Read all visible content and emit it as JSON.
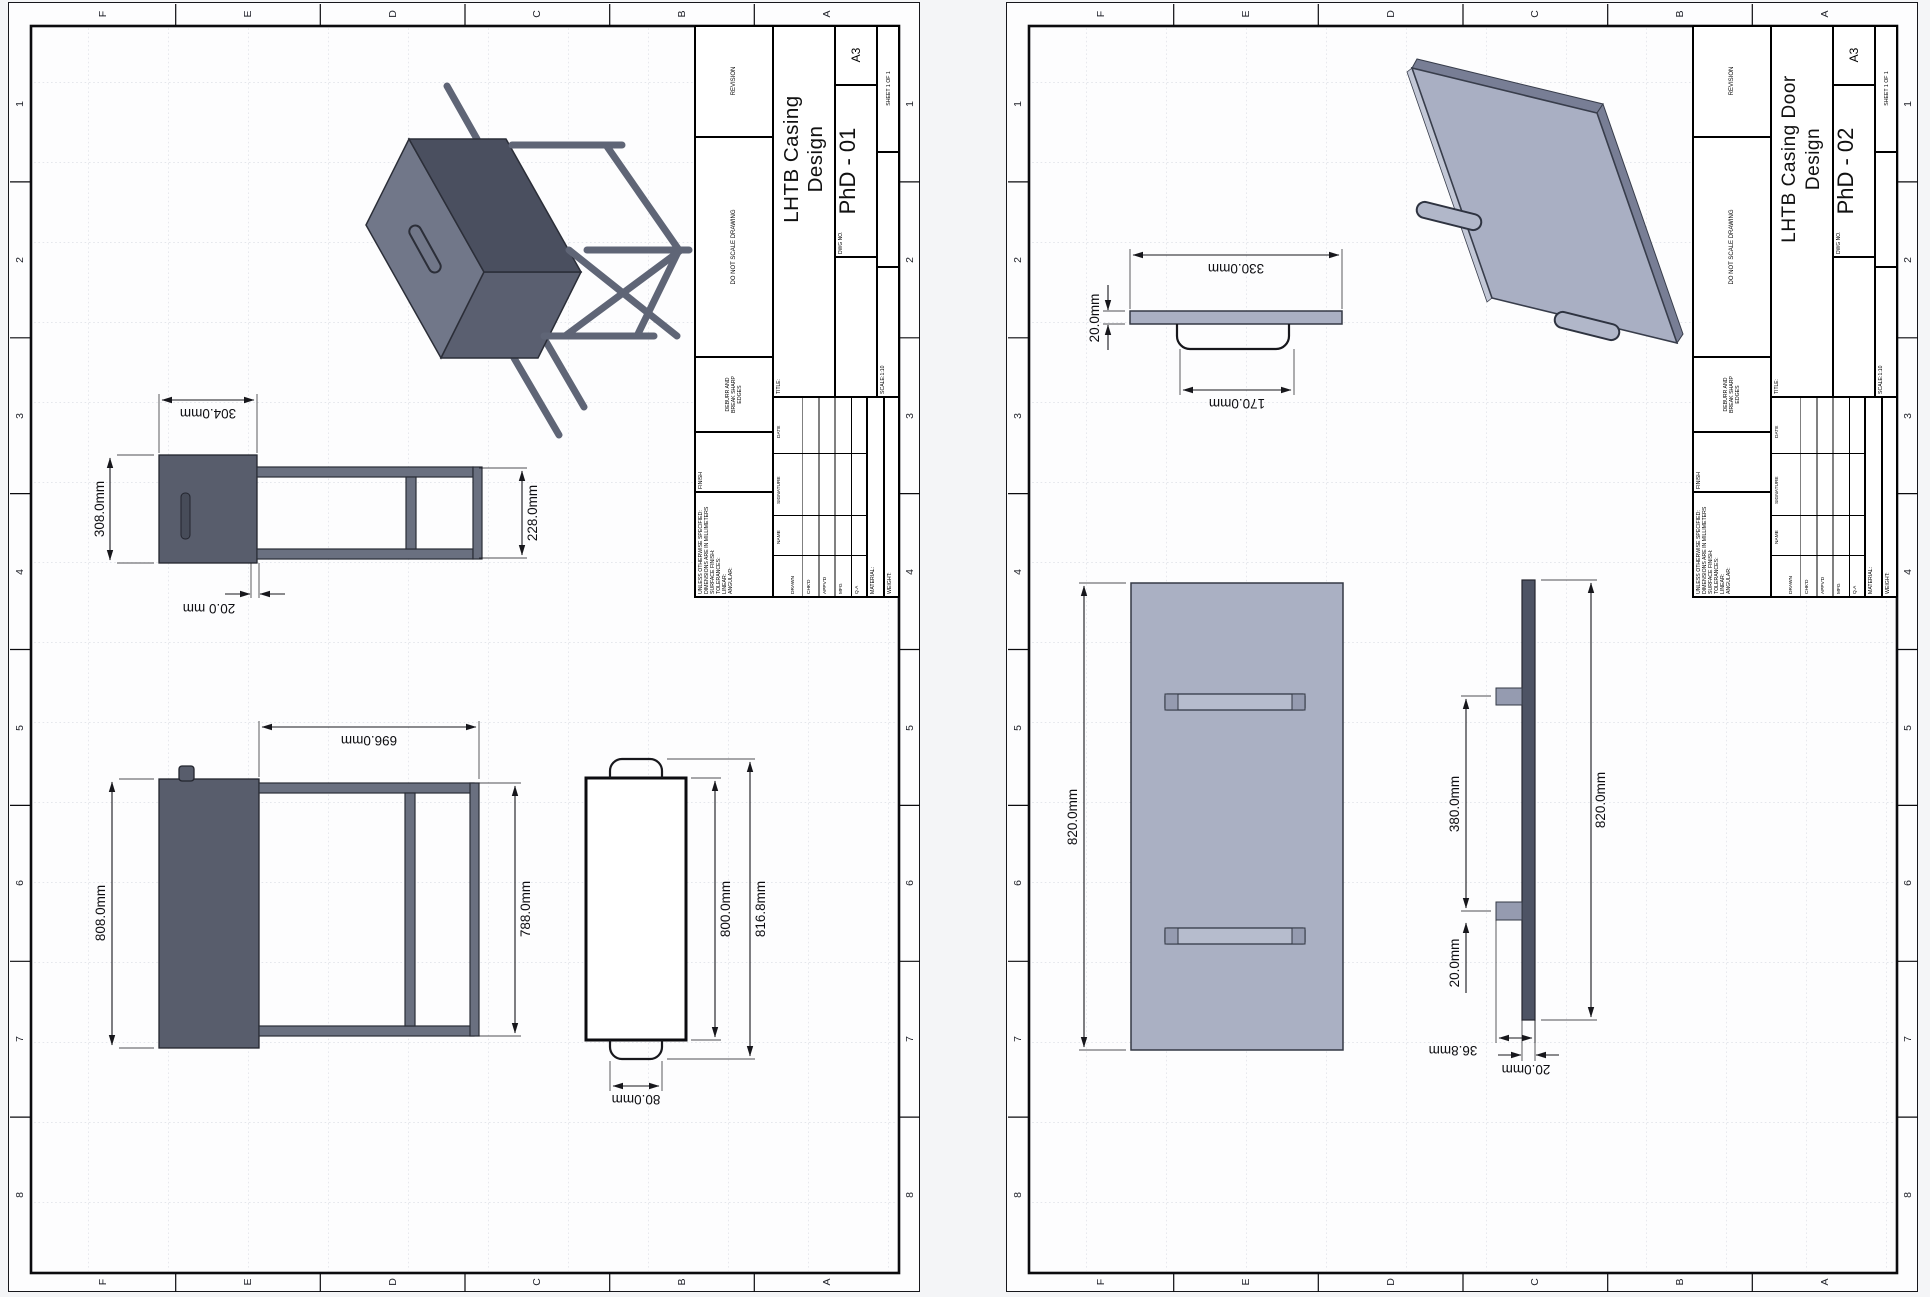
{
  "zones": {
    "letters": [
      "F",
      "E",
      "D",
      "C",
      "B",
      "A"
    ],
    "numbers": [
      "1",
      "2",
      "3",
      "4",
      "5",
      "6",
      "7",
      "8"
    ]
  },
  "titleblock": {
    "unless_lines": [
      "UNLESS OTHERWISE SPECIFIED:",
      "DIMENSIONS ARE IN MILLIMETERS",
      "SURFACE FINISH:",
      "TOLERANCES:",
      "   LINEAR:",
      "   ANGULAR:"
    ],
    "finish": "FINISH",
    "deburr_lines": [
      "DEBURR AND",
      "BREAK SHARP",
      "EDGES"
    ],
    "do_not_scale": "DO NOT SCALE DRAWING",
    "revision": "REVISION",
    "name": "NAME",
    "signature": "SIGNATURE",
    "date": "DATE",
    "rows": [
      "DRAWN",
      "CHK'D",
      "APPV'D",
      "MFG",
      "Q.A"
    ],
    "material": "MATERIAL:",
    "weight": "WEIGHT:",
    "title_label": "TITLE:",
    "dwg_label": "DWG NO.",
    "scale": "SCALE:1:10",
    "sheet_label": "SHEET 1 OF 1",
    "size": "A3"
  },
  "sheets": [
    {
      "title_line1": "LHTB Casing",
      "title_line2": "Design",
      "dwg_no": "PhD - 01",
      "dims": {
        "w304": "304.0mm",
        "w308": "308.0mm",
        "t20": "20.0 mm",
        "w228": "228.0mm",
        "h696": "696.0mm",
        "w808": "808.0mm",
        "w788": "788.0mm",
        "w800": "800.0mm",
        "w8168": "816.8mm",
        "w80": "80.0mm"
      }
    },
    {
      "title_line1": "LHTB Casing Door",
      "title_line2": "Design",
      "dwg_no": "PhD - 02",
      "dims": {
        "w330": "330.0mm",
        "t20": "20.0mm",
        "w170": "170.0mm",
        "h820a": "820.0mm",
        "g380": "380.0mm",
        "g20": "20.0mm",
        "h820b": "820.0mm",
        "t368": "36.8mm",
        "t20b": "20.0mm"
      }
    }
  ]
}
